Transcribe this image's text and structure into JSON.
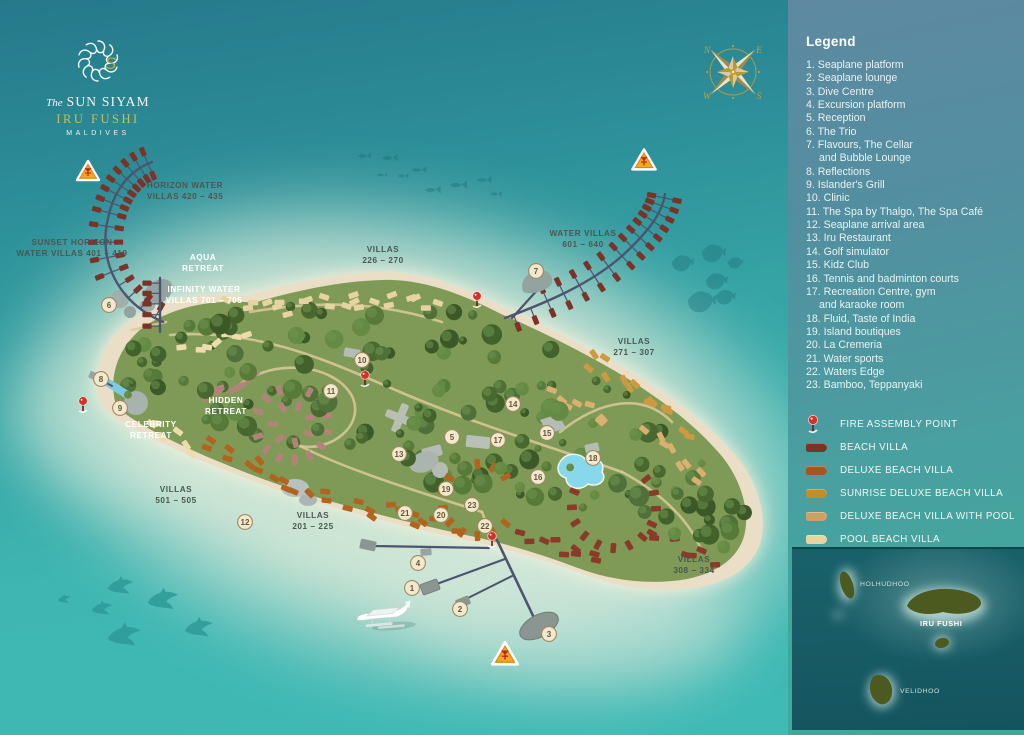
{
  "logo": {
    "prefix": "The",
    "brand": "SUN SIYAM",
    "resort": "IRU FUSHI",
    "country": "MALDIVES"
  },
  "legend": {
    "title": "Legend",
    "items": [
      {
        "num": "1.",
        "label": "Seaplane platform"
      },
      {
        "num": "2.",
        "label": "Seaplane lounge"
      },
      {
        "num": "3.",
        "label": "Dive Centre"
      },
      {
        "num": "4.",
        "label": "Excursion platform"
      },
      {
        "num": "5.",
        "label": "Reception"
      },
      {
        "num": "6.",
        "label": "The Trio"
      },
      {
        "num": "7.",
        "label": "Flavours, The Cellar",
        "label2": "and Bubble Lounge"
      },
      {
        "num": "8.",
        "label": "Reflections"
      },
      {
        "num": "9.",
        "label": "Islander's Grill"
      },
      {
        "num": "10.",
        "label": "Clinic"
      },
      {
        "num": "11.",
        "label": "The Spa by Thalgo, The Spa Café"
      },
      {
        "num": "12.",
        "label": "Seaplane arrival area"
      },
      {
        "num": "13.",
        "label": "Iru Restaurant"
      },
      {
        "num": "14.",
        "label": "Golf simulator"
      },
      {
        "num": "15.",
        "label": "Kidz Club"
      },
      {
        "num": "16.",
        "label": "Tennis and badminton courts"
      },
      {
        "num": "17.",
        "label": "Recreation Centre, gym",
        "label2": "and karaoke room"
      },
      {
        "num": "18.",
        "label": "Fluid, Taste of India"
      },
      {
        "num": "19.",
        "label": "Island boutiques"
      },
      {
        "num": "20.",
        "label": "La Cremeria"
      },
      {
        "num": "21.",
        "label": "Water sports"
      },
      {
        "num": "22.",
        "label": "Waters Edge"
      },
      {
        "num": "23.",
        "label": "Bamboo, Teppanyaki"
      }
    ],
    "key": [
      {
        "label": "FIRE ASSEMBLY POINT",
        "icon": "fire-pin",
        "color": "#d0312b"
      },
      {
        "label": "BEACH VILLA",
        "icon": "swatch",
        "color": "#7b3327"
      },
      {
        "label": "DELUXE BEACH VILLA",
        "icon": "swatch",
        "color": "#a6571d"
      },
      {
        "label": "SUNRISE DELUXE BEACH VILLA",
        "icon": "swatch",
        "color": "#bf8f2d"
      },
      {
        "label": "DELUXE BEACH VILLA WITH POOL",
        "icon": "swatch",
        "color": "#cfa263"
      },
      {
        "label": "POOL BEACH VILLA",
        "icon": "swatch",
        "color": "#e8d3a2"
      }
    ]
  },
  "inset_map": {
    "islands": [
      {
        "name": "HOLHUDHOO",
        "bold": false
      },
      {
        "name": "IRU FUSHI",
        "bold": true
      },
      {
        "name": "VELIDHOO",
        "bold": false
      }
    ]
  },
  "map": {
    "compass_letters": [
      "N",
      "E",
      "W",
      "S"
    ],
    "area_labels": [
      {
        "lines": [
          "HORIZON WATER",
          "VILLAS 420 – 435"
        ],
        "x": 185,
        "y": 188,
        "style": "dark"
      },
      {
        "lines": [
          "SUNSET HORIZON",
          "WATER VILLAS 401 – 419"
        ],
        "x": 72,
        "y": 245,
        "style": "dark"
      },
      {
        "lines": [
          "WATER VILLAS",
          "601 – 640"
        ],
        "x": 583,
        "y": 236,
        "style": "dark"
      },
      {
        "lines": [
          "VILLAS",
          "226 – 270"
        ],
        "x": 383,
        "y": 252,
        "style": "dark"
      },
      {
        "lines": [
          "VILLAS",
          "271 – 307"
        ],
        "x": 634,
        "y": 344,
        "style": "dark"
      },
      {
        "lines": [
          "VILLAS",
          "501 – 505"
        ],
        "x": 176,
        "y": 492,
        "style": "dark"
      },
      {
        "lines": [
          "VILLAS",
          "201 – 225"
        ],
        "x": 313,
        "y": 518,
        "style": "dark"
      },
      {
        "lines": [
          "VILLAS",
          "308 – 334"
        ],
        "x": 694,
        "y": 562,
        "style": "dark"
      },
      {
        "lines": [
          "AQUA",
          "RETREAT"
        ],
        "x": 203,
        "y": 260,
        "style": "light"
      },
      {
        "lines": [
          "INFINITY WATER",
          "VILLAS 701 – 705"
        ],
        "x": 204,
        "y": 292,
        "style": "light"
      },
      {
        "lines": [
          "HIDDEN",
          "RETREAT"
        ],
        "x": 226,
        "y": 403,
        "style": "light"
      },
      {
        "lines": [
          "CELEBRITY",
          "RETREAT"
        ],
        "x": 151,
        "y": 427,
        "style": "light"
      }
    ],
    "markers": [
      {
        "n": "1",
        "x": 412,
        "y": 588
      },
      {
        "n": "2",
        "x": 460,
        "y": 609
      },
      {
        "n": "3",
        "x": 549,
        "y": 634
      },
      {
        "n": "4",
        "x": 418,
        "y": 563
      },
      {
        "n": "5",
        "x": 452,
        "y": 437
      },
      {
        "n": "6",
        "x": 109,
        "y": 305
      },
      {
        "n": "7",
        "x": 536,
        "y": 271
      },
      {
        "n": "8",
        "x": 101,
        "y": 379
      },
      {
        "n": "9",
        "x": 120,
        "y": 408
      },
      {
        "n": "10",
        "x": 362,
        "y": 360
      },
      {
        "n": "11",
        "x": 331,
        "y": 391
      },
      {
        "n": "12",
        "x": 245,
        "y": 522
      },
      {
        "n": "13",
        "x": 399,
        "y": 454
      },
      {
        "n": "14",
        "x": 513,
        "y": 404
      },
      {
        "n": "15",
        "x": 547,
        "y": 433
      },
      {
        "n": "16",
        "x": 538,
        "y": 477
      },
      {
        "n": "17",
        "x": 498,
        "y": 440
      },
      {
        "n": "18",
        "x": 593,
        "y": 458
      },
      {
        "n": "19",
        "x": 446,
        "y": 489
      },
      {
        "n": "20",
        "x": 441,
        "y": 515
      },
      {
        "n": "21",
        "x": 405,
        "y": 513
      },
      {
        "n": "22",
        "x": 485,
        "y": 526
      },
      {
        "n": "23",
        "x": 472,
        "y": 505
      }
    ],
    "fire_pins": [
      {
        "x": 83,
        "y": 403
      },
      {
        "x": 477,
        "y": 298
      },
      {
        "x": 365,
        "y": 377
      },
      {
        "x": 492,
        "y": 538
      }
    ],
    "warning_triangles": [
      {
        "x": 88,
        "y": 172,
        "s": 1.0
      },
      {
        "x": 644,
        "y": 161,
        "s": 1.05
      },
      {
        "x": 505,
        "y": 655,
        "s": 1.15
      }
    ]
  }
}
